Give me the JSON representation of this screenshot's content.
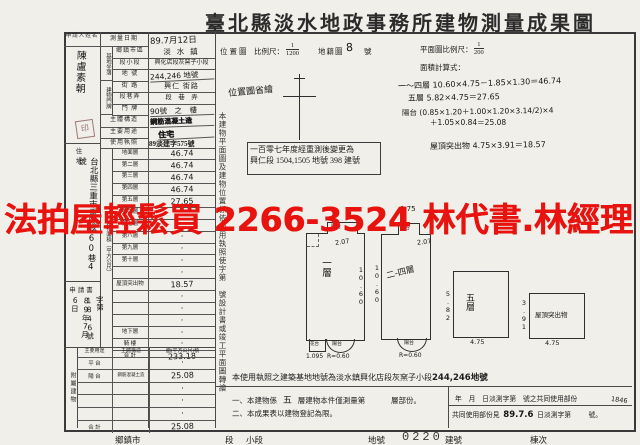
{
  "colors": {
    "watermark": "#e8120e",
    "paper": "#f1efe9",
    "ink": "#1e1e1e"
  },
  "title": "臺北縣淡水地政事務所建物測量成果圖",
  "watermark": "法拍屋輕鬆買 2266-3524 林代書.林經理",
  "applicant": {
    "label": "申請人姓名",
    "name": "陳盧素朝",
    "seal": "印"
  },
  "survey": {
    "label": "測量日期",
    "value": "89.7月12日"
  },
  "site": {
    "group": "基地坐落",
    "rows": [
      {
        "label": "鄉鎮市區",
        "value": "淡 水 鎮"
      },
      {
        "label": "段小段",
        "value": "興化店段灰窯子小段"
      },
      {
        "label": "地 號",
        "value": "244,246 地號"
      }
    ]
  },
  "door": {
    "group": "建物門牌",
    "rows": [
      {
        "label": "街 路",
        "value": "興仁 街路"
      },
      {
        "label": "段巷弄",
        "value": "段　巷　弄"
      },
      {
        "label": "門 牌",
        "value": "90號　之　樓"
      }
    ]
  },
  "info_rows": [
    {
      "label": "主體構造",
      "value": "鋼筋混凝土造"
    },
    {
      "label": "主要用途",
      "value": "住宅"
    },
    {
      "label": "使用執照",
      "value": "89淡建字575號"
    }
  ],
  "address": {
    "label": "住　址",
    "value": "台北縣三重市重陽路60巷4號"
  },
  "application": {
    "label": "申請書",
    "line1": "89年7月6日",
    "line2": "字第1846號"
  },
  "floor_area": {
    "side_label": "建物面積（平方公尺）",
    "rows": [
      [
        "地面層",
        "46.74"
      ],
      [
        "第二層",
        "46.74"
      ],
      [
        "第三層",
        "46.74"
      ],
      [
        "第四層",
        "46.74"
      ],
      [
        "第五層",
        "27.65"
      ],
      [
        "第六層",
        "·"
      ],
      [
        "第七層",
        "·"
      ],
      [
        "第八層",
        "·"
      ],
      [
        "第九層",
        "·"
      ],
      [
        "第十層",
        "·"
      ],
      [
        "",
        "·"
      ],
      [
        "屋頂突出物",
        "18.57"
      ],
      [
        "",
        "·"
      ],
      [
        "",
        "·"
      ],
      [
        "",
        "·"
      ],
      [
        "地下層",
        "·"
      ],
      [
        "騎 樓",
        "·"
      ],
      [
        "合 計",
        "233.18"
      ]
    ]
  },
  "annex": {
    "side_label": "附屬建物",
    "headers": [
      "主要用途",
      "主體構造",
      "面(平方公尺)積"
    ],
    "rows": [
      [
        "平 台",
        "",
        "·"
      ],
      [
        "陽 台",
        "鋼筋混凝土造",
        "25.08"
      ],
      [
        "",
        "",
        "·"
      ],
      [
        "",
        "",
        "·"
      ],
      [
        "",
        "",
        "·"
      ],
      [
        "合 計",
        "",
        "25.08"
      ]
    ]
  },
  "side_caption": "本建物平面圖及建物位置係依使用執照使字第　號設計書或竣工平面圖轉繪",
  "map": {
    "label": "位置圖",
    "scale_label": "比例尺：",
    "scale_num": "1",
    "scale_den": "1200",
    "cadastral_label": "地籍圖",
    "sheet_no": "8",
    "sheet_suffix": "號",
    "note": "位置圖省繪"
  },
  "plan": {
    "scale_label": "平面圖比例尺：",
    "scale_num": "1",
    "scale_den": "200",
    "calc_label": "面積計算式：",
    "calc_lines": [
      "一～四層 10.60×4.75－1.85×1.30＝46.74",
      "五層 5.82×4.75＝27.65",
      "陽台 (0.85×1.20＋1.00×1.20×3.14/2)×4",
      "＋1.05×0.84＝25.08",
      "屋頂突出物 4.75×3.91＝18.57"
    ]
  },
  "resurvey_note": {
    "line1": "一百零七年度經重測後變更為",
    "line2": "興仁段 1504,1505 地號 398 建號"
  },
  "plans": [
    {
      "name": "一層",
      "right_dim": "10.60",
      "bump_label": "陽台",
      "bump_dim": "2.07",
      "bottom1_label": "花台",
      "bottom1_dim": "1.095",
      "bottom2_label": "陽台",
      "bottom2_dim": "R=0.60"
    },
    {
      "name": "二-四層",
      "left_dim": "10.60",
      "bump_label": "陽台",
      "bump_dim": "2.07",
      "top_note": "9.75",
      "bottom2_label": "陽台",
      "bottom2_dim": "R=0.60"
    },
    {
      "name": "五層",
      "left_dim": "5.82",
      "bottom_dim": "4.75"
    },
    {
      "name": "屋頂突出物",
      "left_dim": "3.91",
      "bottom_dim": "4.75"
    }
  ],
  "bottom": {
    "license_line": "本使用執照之建築基地地號為淡水鎮興化店段灰窯子小段",
    "license_bold": "244,246地號",
    "note1_a": "一、本建物係",
    "note1_hw": "五",
    "note1_b": "層建物本件僅測量第",
    "note1_c": "層部份。",
    "note2": "二、本成果表以建物登記為限。",
    "common": {
      "line1": "年　月　日淡測字第　號之共同使用部份",
      "hw_no": "1846",
      "line2_a": "共同使用部份見",
      "hw_date": "89.7.6",
      "line2_b": "日淡測字第",
      "line2_c": "號。"
    }
  },
  "footer": {
    "items": [
      "鄉鎮市",
      "段",
      "小段",
      "地號",
      "建號",
      "棟次"
    ],
    "stamp": "0220"
  }
}
